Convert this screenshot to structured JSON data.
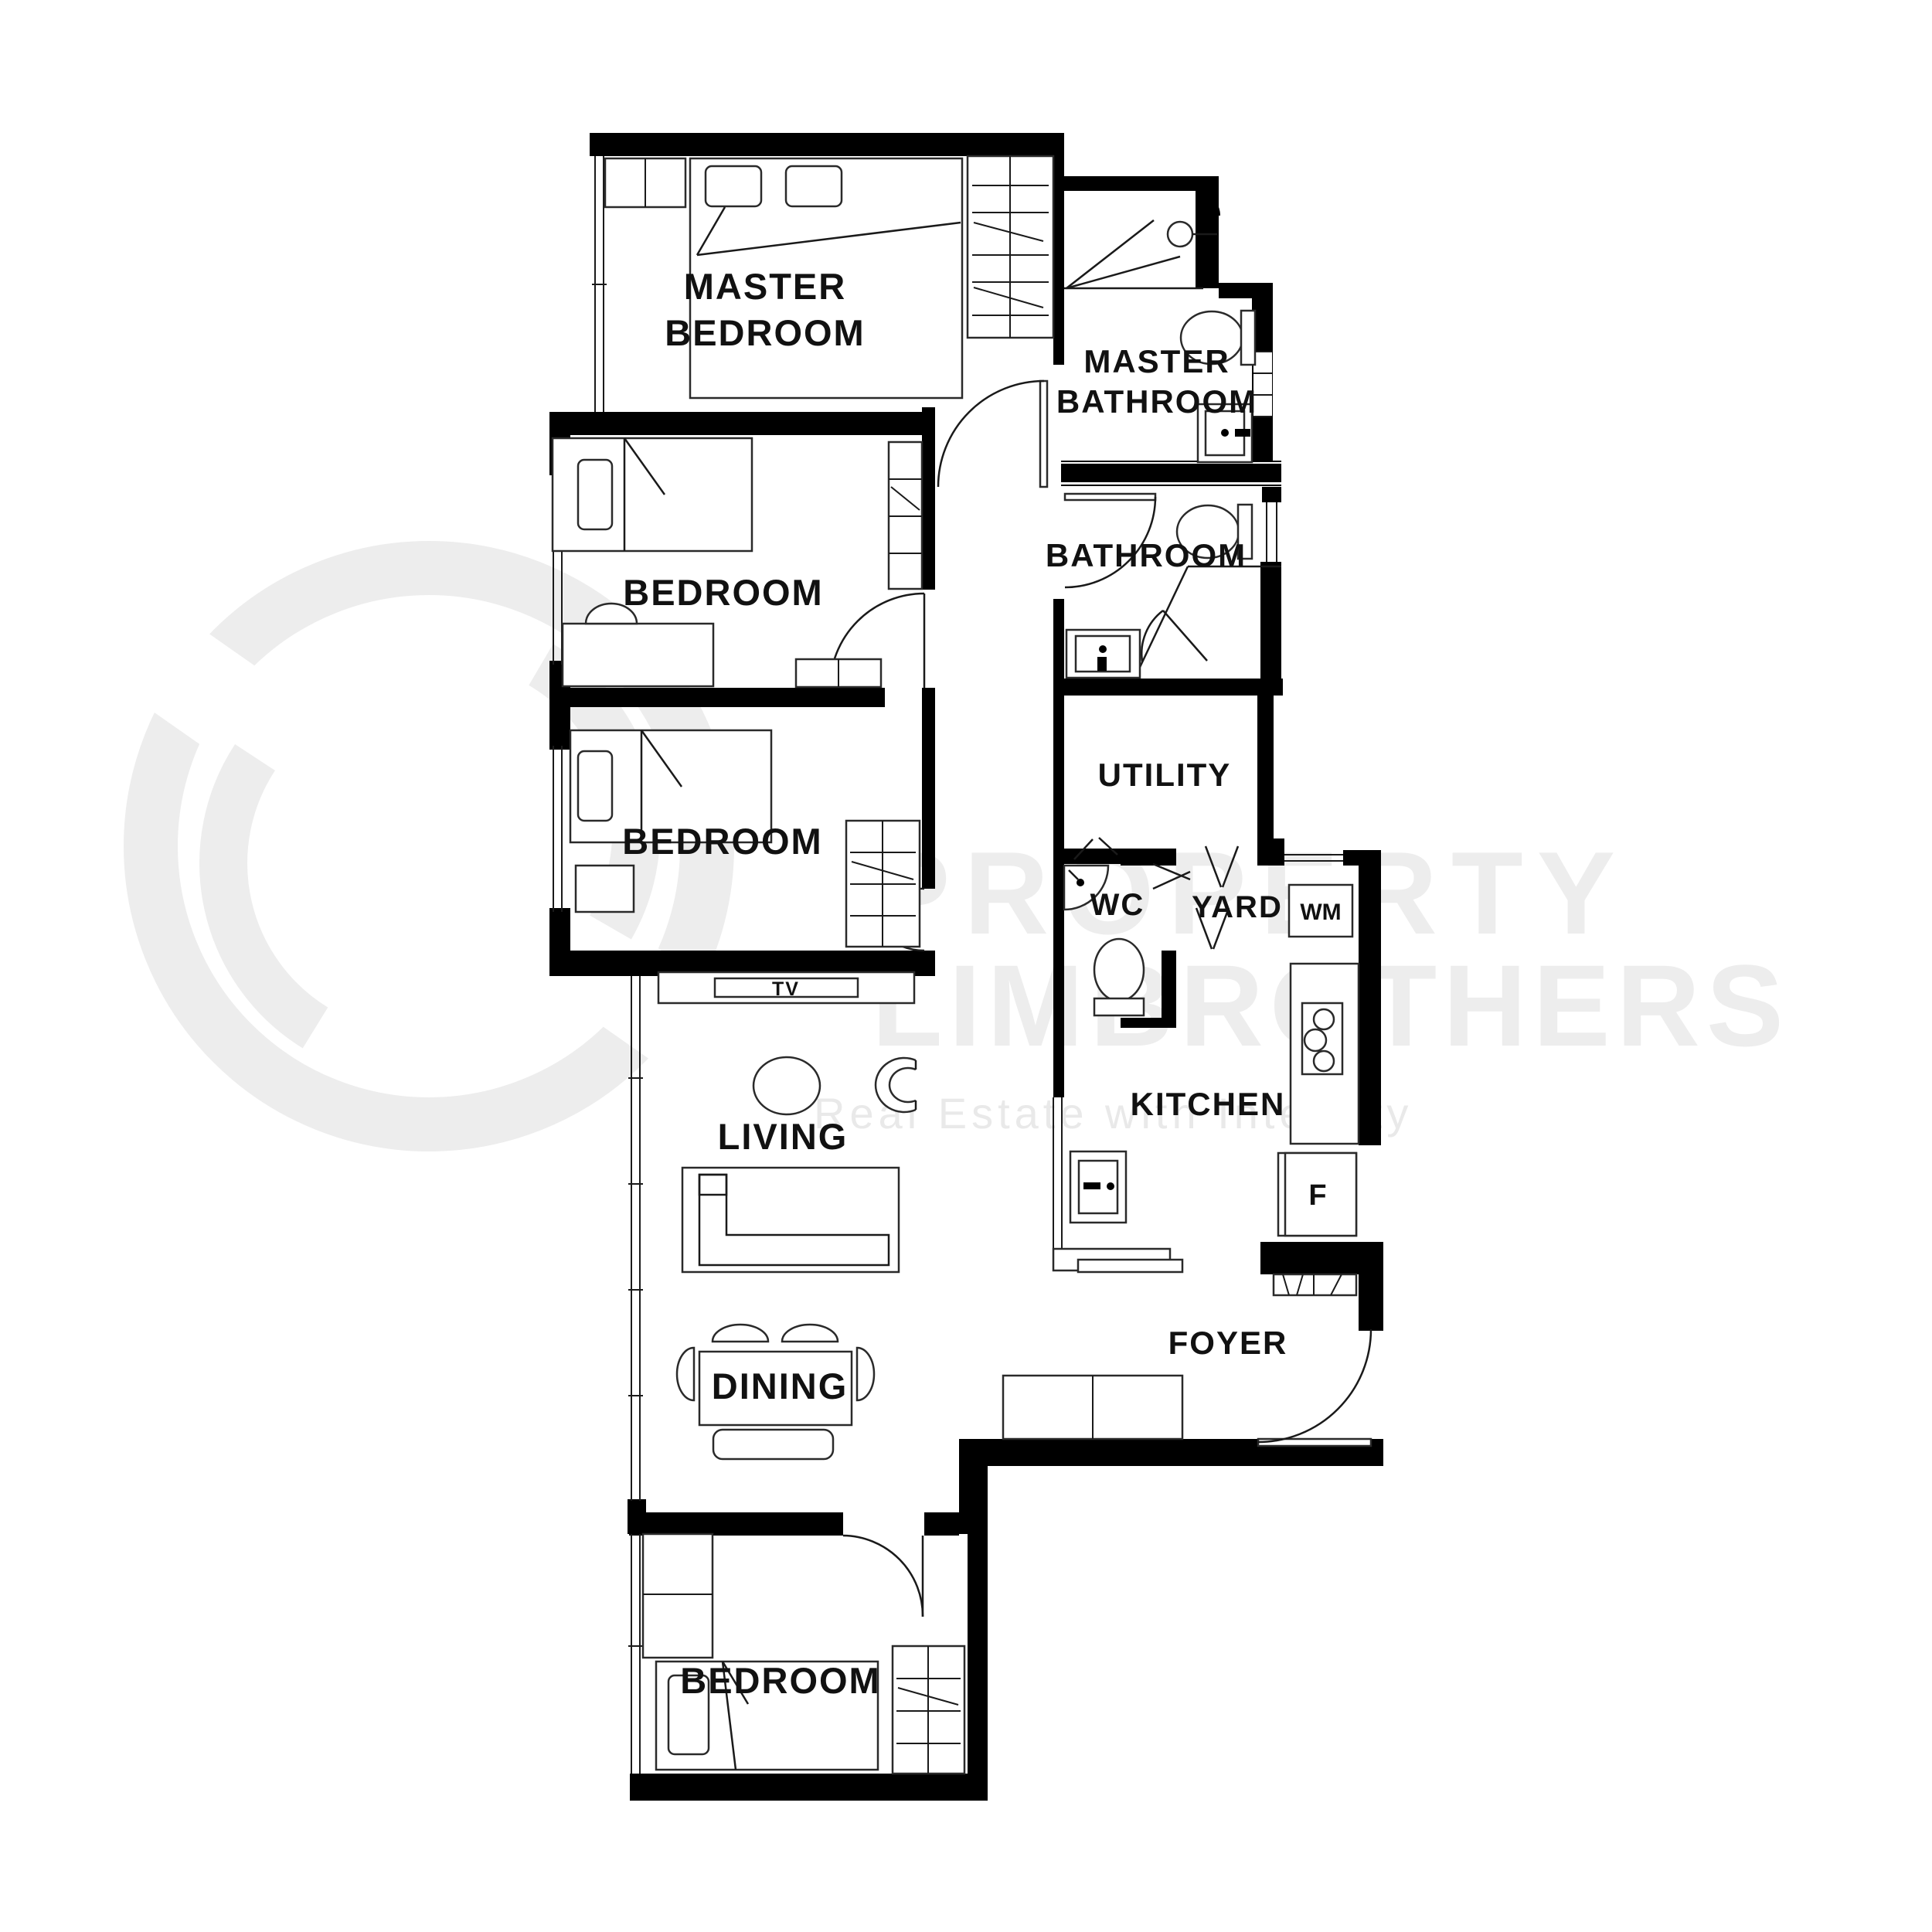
{
  "watermark": {
    "line1": "PROPERTY",
    "line2": "LIMBROTHERS",
    "tagline": "Real Estate with Integrity",
    "color": "#ededed"
  },
  "rooms": {
    "master_bedroom": {
      "label_line1": "MASTER",
      "label_line2": "BEDROOM"
    },
    "master_bathroom": {
      "label_line1": "MASTER",
      "label_line2": "BATHROOM"
    },
    "bedroom_mid": {
      "label": "BEDROOM"
    },
    "bathroom": {
      "label": "BATHROOM"
    },
    "bedroom_lower": {
      "label": "BEDROOM"
    },
    "utility": {
      "label": "UTILITY"
    },
    "wc": {
      "label": "WC"
    },
    "yard": {
      "label": "YARD"
    },
    "kitchen": {
      "label": "KITCHEN"
    },
    "living": {
      "label": "LIVING"
    },
    "dining": {
      "label": "DINING"
    },
    "foyer": {
      "label": "FOYER"
    },
    "bedroom_bottom": {
      "label": "BEDROOM"
    }
  },
  "appliances": {
    "tv": "TV",
    "washing_machine": "WM",
    "fridge": "F"
  },
  "colors": {
    "background": "#ffffff",
    "walls": "#000000",
    "label_text": "#111111",
    "watermark": "#ededed"
  }
}
